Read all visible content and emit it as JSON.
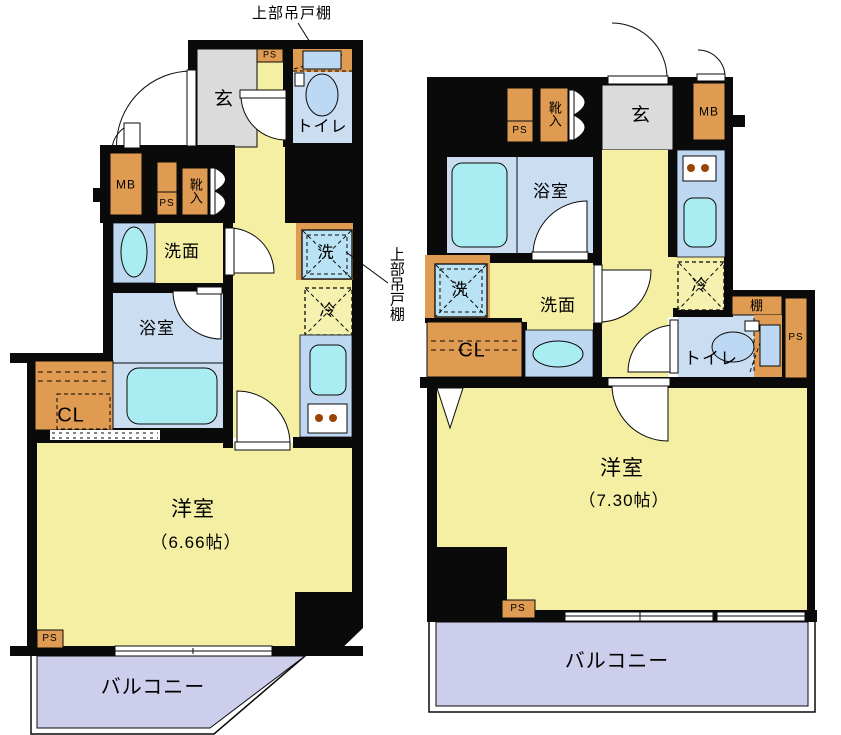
{
  "annotations": {
    "top_hanging_cabinet": "上部吊戸棚",
    "side_hanging_cabinet": "上部吊戸棚"
  },
  "left_unit": {
    "entrance": "玄",
    "toilet": "トイレ",
    "ps_top": "PS",
    "mb": "MB",
    "ps_mid": "PS",
    "shoe_cabinet": "靴入",
    "washroom": "洗面",
    "bathroom": "浴室",
    "closet": "CL",
    "washer": "洗",
    "fridge": "冷",
    "room": "洋室",
    "room_size": "（6.66帖）",
    "ps_bottom": "PS",
    "balcony": "バルコニー"
  },
  "right_unit": {
    "entrance": "玄",
    "mb": "MB",
    "ps_top": "PS",
    "shoe_cabinet": "靴入",
    "bathroom": "浴室",
    "washer": "洗",
    "washroom": "洗面",
    "closet": "CL",
    "fridge": "冷",
    "shelf": "棚",
    "toilet": "トイレ",
    "ps_toilet": "PS",
    "room": "洋室",
    "room_size": "（7.30帖）",
    "ps_bottom": "PS",
    "balcony": "バルコニー"
  },
  "colors": {
    "wall": "#0a0a0a",
    "floor_yellow": "#F4EFA3",
    "entry_gray": "#DBDBDB",
    "wet_room_blue": "#CBDDF1",
    "counter_blue": "#BDD8F0",
    "fixture_cyan": "#A9ECF2",
    "toilet_blue": "#BDD8F2",
    "washer_blue": "#B9E2F4",
    "cabinet_orange": "#DE9B51",
    "balcony_purple": "#CDCDEC",
    "stove_dot_brown": "#994400"
  }
}
